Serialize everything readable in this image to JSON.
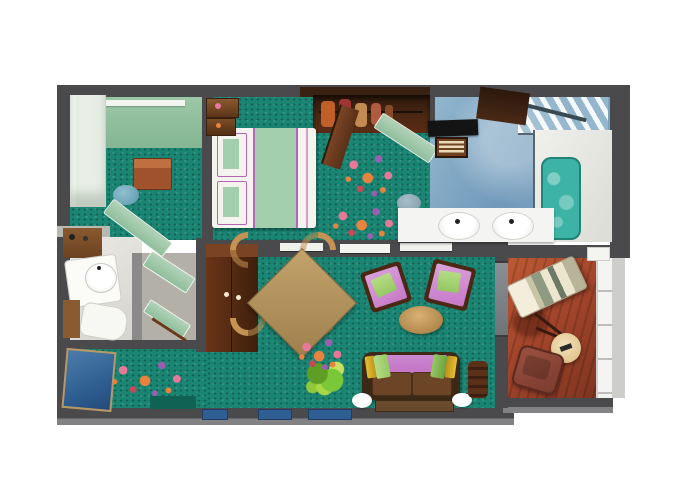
{
  "meta": {
    "type": "floor-plan",
    "description": "Top-down 3D rendered floor plan of a one-bedroom suite with balcony (no text labels rendered)",
    "width_px": 680,
    "height_px": 486
  },
  "palette": {
    "wall": "#4a4a4c",
    "wall_light": "#828284",
    "wall_white": "#b9b9b4",
    "carpet": "#1b8573",
    "carpet_dark": "#0f6354",
    "sage": "#8fbf9c",
    "sage_light": "#b2d2b8",
    "wardrobe_white": "#e9efe7",
    "wood_dark": "#4a2814",
    "wood_mid": "#7a4424",
    "wood_light": "#b3925f",
    "wood_table": "#a0522d",
    "bed_white": "#f5f3ed",
    "bed_green": "#a3cfae",
    "accent_purple": "#b565b5",
    "bath_blue": "#7da6c2",
    "bath_blue_light": "#a5c3d6",
    "tub_teal": "#3cb3a4",
    "counter_white": "#f4f4f2",
    "glass": "#b9d3e2",
    "deck": "#a4462b",
    "deck_dark": "#7e3520",
    "lounger_cream": "#eee9d6",
    "chair_purple": "#c678c8",
    "chair_purple_light": "#daa2da",
    "pillow_green": "#96c862",
    "pillow_yellow": "#e8be32",
    "sofa_frame": "#3c2817",
    "sofa_seat": "#6b4526",
    "mat_blue": "#2f5f92",
    "stool_blue": "#6ba3b8",
    "plant_green": "#7ac838",
    "flower_pink": "#e87898",
    "flower_orange": "#e8823c",
    "flower_violet": "#9a5fb0",
    "flower_red": "#c84858",
    "vestibule_gray": "#b3b0a8",
    "balustrade": "#f4f4f2",
    "hull": "#cdcdcb"
  },
  "rooms": [
    {
      "name": "bedroom",
      "floor": "teal-carpet",
      "furniture": [
        "king-bed",
        "two-pillows",
        "nightstands",
        "walk-in-closet-hanging-clothes",
        "flower-carpet-motifs"
      ]
    },
    {
      "name": "dressing-corner",
      "floor": "teal-carpet",
      "furniture": [
        "white-wardrobe",
        "sage-dresser-counter",
        "wood-side-table",
        "blue-stool",
        "angled-mirror-door"
      ]
    },
    {
      "name": "master-bathroom",
      "floor": "blue-tile",
      "furniture": [
        "double-sink-counter",
        "bathtub",
        "glass-shower",
        "black-vanity-top",
        "amenity-tray",
        "wood-door"
      ]
    },
    {
      "name": "guest-toilet",
      "floor": "stone",
      "furniture": [
        "washbasin",
        "toilet",
        "wood-vanity"
      ]
    },
    {
      "name": "entry-hall",
      "floor": "teal-carpet",
      "furniture": [
        "blue-door-mat",
        "flower-carpet-motifs",
        "vestibule-mirror-panels"
      ]
    },
    {
      "name": "living-dining-room",
      "floor": "teal-carpet",
      "furniture": [
        "entry-wardrobe",
        "square-dining-table",
        "four-dining-chairs",
        "two-armchairs",
        "oval-coffee-table",
        "sofa-with-pillows",
        "area-rug",
        "green-plant",
        "planter-urn",
        "two-white-floor-domes",
        "flower-carpet-motifs"
      ]
    },
    {
      "name": "balcony",
      "floor": "red-wood-deck",
      "furniture": [
        "sun-lounger",
        "round-side-table",
        "deck-chair",
        "glass-balustrade"
      ]
    }
  ]
}
